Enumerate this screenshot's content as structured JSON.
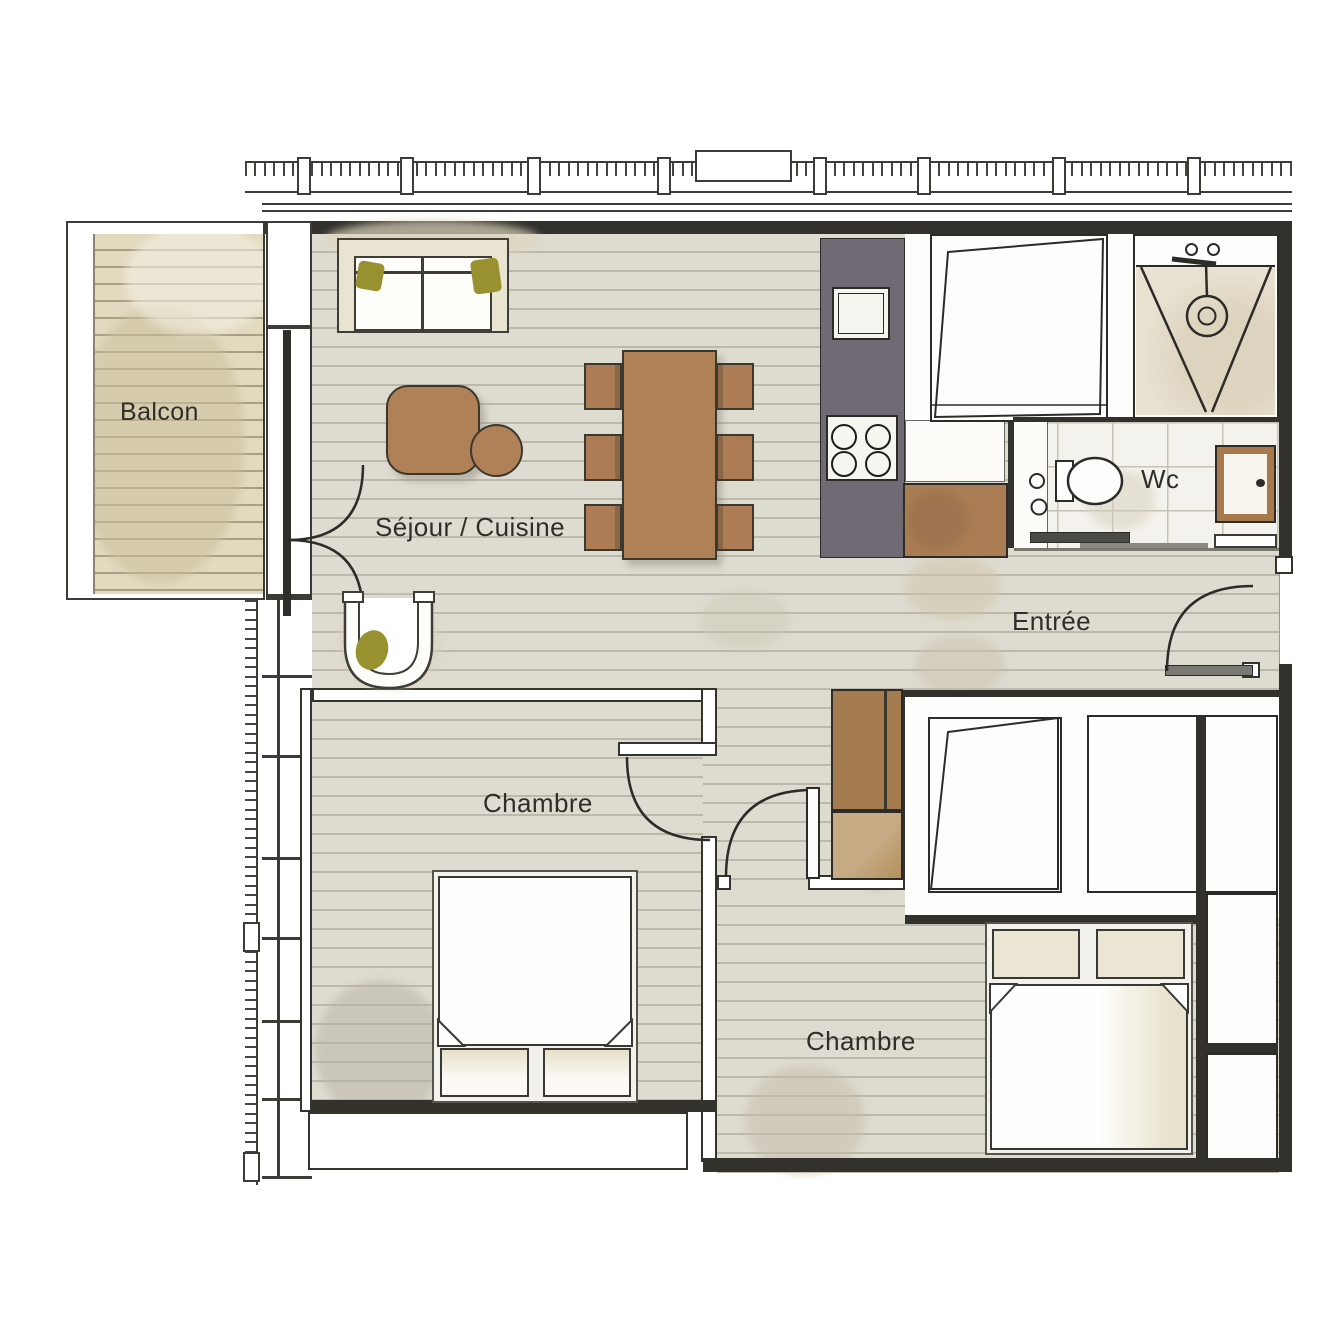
{
  "plan": {
    "type": "apartment-floor-plan",
    "rooms": {
      "balcony": {
        "label": "Balcon"
      },
      "living_kitchen": {
        "label": "Séjour / Cuisine"
      },
      "entry": {
        "label": "Entrée"
      },
      "wc": {
        "label": "Wc"
      },
      "bedroom_1": {
        "label": "Chambre"
      },
      "bedroom_2": {
        "label": "Chambre"
      }
    },
    "fixtures": [
      "sofa",
      "olive-cushions",
      "coffee-table",
      "side-table",
      "armchair",
      "dining-table-6-chairs",
      "kitchen-counter",
      "kitchen-sink",
      "hob-4-burners",
      "worktop",
      "tall-closet",
      "wardrobe",
      "shower",
      "shower-head",
      "toilet",
      "washbasin-cabinet",
      "sliding-door",
      "entry-door",
      "double-bed-1",
      "double-bed-2",
      "balcony-french-doors",
      "railing"
    ],
    "palette": {
      "wall": "#32312c",
      "line": "#2c2b27",
      "floor": "#dedbd1",
      "floor_line": "#bcb8aa",
      "deck": "#e2dabf",
      "deck_line": "#a89e82",
      "wood_brown": "#b08157",
      "chair_brown": "#ad7c54",
      "counter_gray": "#6f6a73",
      "cabinet_brown": "#a9794e",
      "upholstery_beige": "#e9e4d1",
      "pillow_olive": "#99912f",
      "tile": "#f4f2ec",
      "linen_beige": "#e8e2cd"
    }
  }
}
